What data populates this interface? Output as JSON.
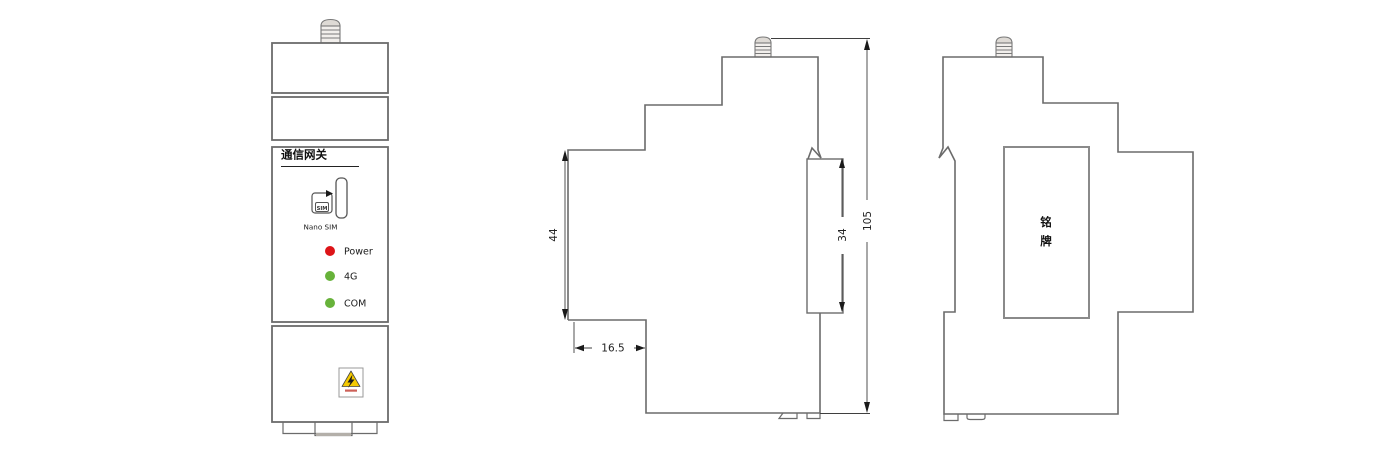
{
  "front": {
    "label": "通信网关",
    "sim": {
      "chip": "SIM",
      "caption": "Nano SIM"
    },
    "leds": [
      {
        "name": "power",
        "label": "Power",
        "color": "#dd1418"
      },
      {
        "name": "4g",
        "label": "4G",
        "color": "#67b23a"
      },
      {
        "name": "com",
        "label": "COM",
        "color": "#67b23a"
      }
    ],
    "warning_icon": "high-voltage-warning"
  },
  "side": {
    "dim_44": "44",
    "dim_16_5": "16.5",
    "dim_34": "34",
    "dim_105": "105"
  },
  "back": {
    "nameplate": [
      "铭",
      "牌"
    ]
  },
  "colors": {
    "line": "#6b6b6b",
    "dimension": "#3f3f3f",
    "led_red": "#dd1418",
    "led_green": "#67b23a",
    "warning_yellow": "#f4c900"
  }
}
